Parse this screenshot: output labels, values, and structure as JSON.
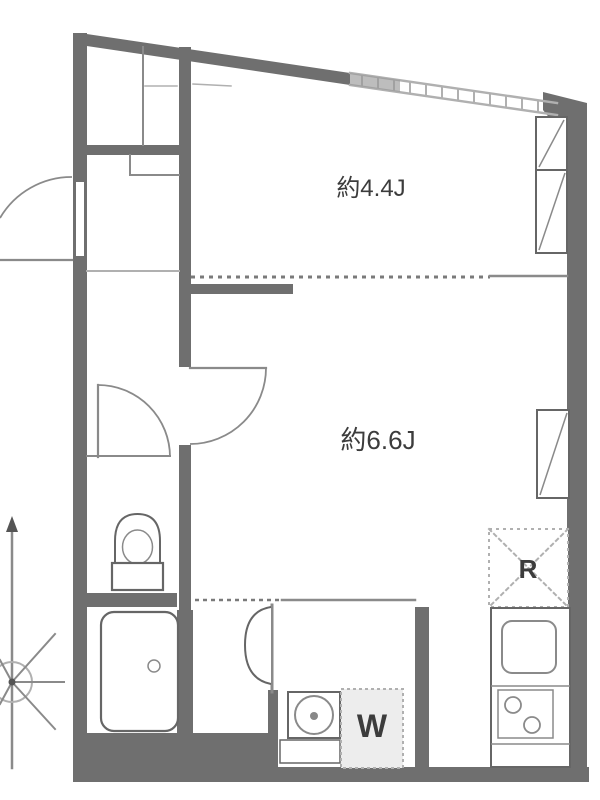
{
  "plan": {
    "rooms": [
      {
        "label": "約4.4J"
      },
      {
        "label": "約6.6J"
      }
    ],
    "fixtures": {
      "refrigerator_label": "R",
      "washer_label": "W"
    }
  },
  "colors": {
    "wall": "#6f6f6f",
    "line": "#8a8a8a",
    "line_light": "#b0b0b0",
    "fixture": "#666666",
    "dash": "#7a7a7a",
    "text": "#3c3c3c",
    "pan_fill": "#ededed"
  }
}
